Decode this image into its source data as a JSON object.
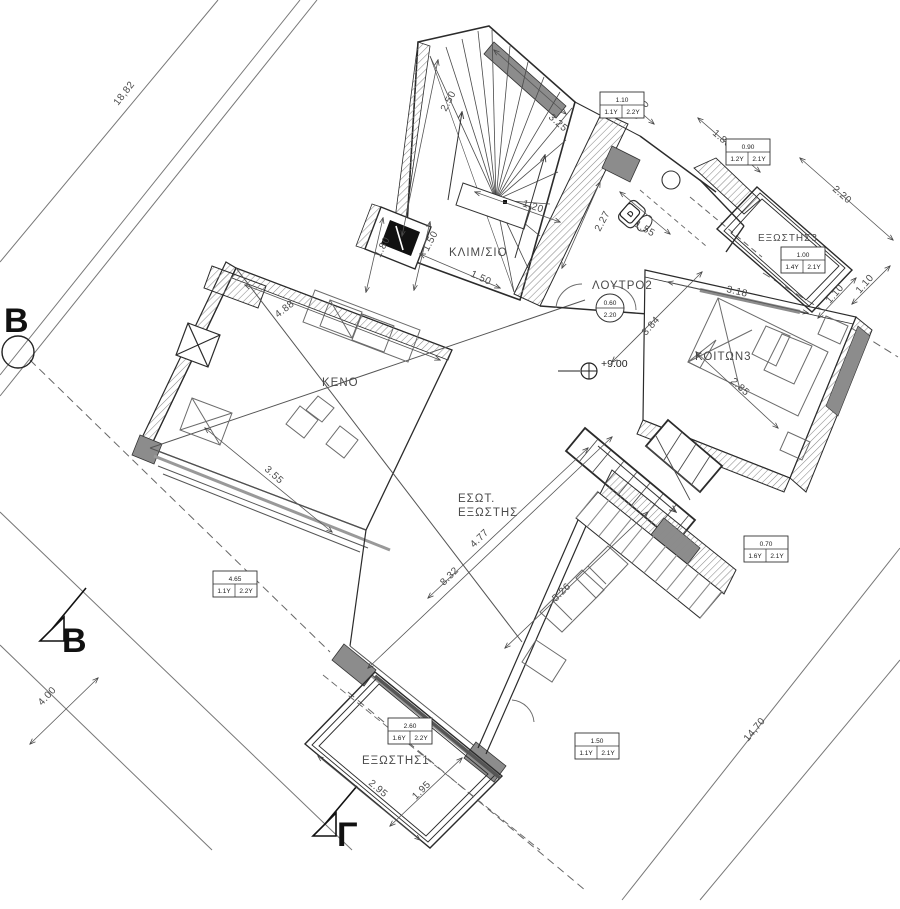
{
  "drawing": {
    "type": "architectural-floor-plan",
    "rooms": {
      "stairwell": "ΚΛΙΜ/ΣΙΟ",
      "bathroom": "ΛΟΥΤΡΟ2",
      "bedroom": "ΚΟΙΤΩΝ3",
      "void": "ΚΕΝΟ",
      "inner_balcony_line1": "ΕΣΩΤ.",
      "inner_balcony_line2": "ΕΞΩΣΤΗΣ",
      "balcony1": "ΕΞΩΣΤΗΣ1",
      "balcony3": "ΕΞΩΣΤΗΣ3"
    },
    "level_mark": "+9.00",
    "section_markers": {
      "left": "B",
      "bottom_left": "B",
      "bottom": "Γ"
    },
    "site_dims": {
      "northwest": "18,82",
      "southwest": "4.00",
      "southeast": "14,70"
    },
    "dims": {
      "stair_a": "2.50",
      "stair_b": "3.25",
      "stair_c": "1.20",
      "stair_d": "1.50",
      "lift_a": "1.80",
      "lift_b": "1.50",
      "bath_a": "2.27",
      "bath_b": "1.55",
      "bath_c": "0.80",
      "bath_d": "3.84",
      "bed_a": "3.18",
      "bed_b": "2.85",
      "bed_c": "1.10",
      "bal3_a": "2.20",
      "bal3_b": "1.10",
      "bal3_c": "1.80",
      "keno_a": "4.88",
      "keno_b": "3.55",
      "ter_a": "4.77",
      "ter_b": "8.32",
      "ter_c": "5.26",
      "bal1_a": "2.95",
      "bal1_b": "1.95"
    },
    "tags": {
      "t1": {
        "w": "1.10",
        "a": "1.1Υ",
        "b": "2.2Υ"
      },
      "t2": {
        "w": "0.90",
        "a": "1.2Υ",
        "b": "2.1Υ"
      },
      "t3": {
        "w": "1.00",
        "a": "1.4Υ",
        "b": "2.1Υ"
      },
      "t4": {
        "w": "4.65",
        "a": "1.1Υ",
        "b": "2.2Υ"
      },
      "t5": {
        "w": "2.60",
        "a": "1.6Υ",
        "b": "2.2Υ"
      },
      "t6": {
        "w": "1.50",
        "a": "1.1Υ",
        "b": "2.1Υ"
      },
      "t7": {
        "w": "0.70",
        "a": "1.6Υ",
        "b": "2.1Υ"
      }
    },
    "circle_tag": {
      "top": "0.60",
      "bottom": "2.20"
    },
    "door_tag": "D",
    "colors": {
      "line": "#2b2b2b",
      "thin": "#6b6b6b",
      "grayfill": "#8c8c8c",
      "dash": "#666666"
    }
  }
}
